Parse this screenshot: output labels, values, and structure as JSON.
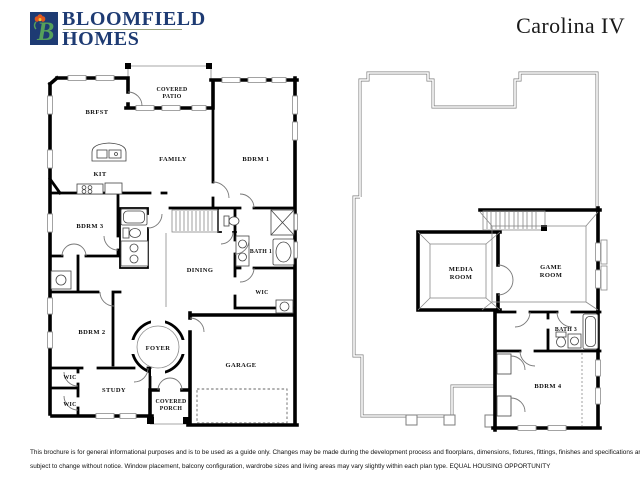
{
  "header": {
    "brand": {
      "line1": "BLOOMFIELD",
      "line2": "HOMES",
      "color": "#1e3b73"
    },
    "logo": {
      "icon": "tulip-b-monogram",
      "monogram": "B",
      "bg": "#1e3b73",
      "b_color": "#55a05a",
      "tulip_color": "#e0561e",
      "tulip_center": "#f2c12e"
    },
    "plan_name": "Carolina IV"
  },
  "floor1": {
    "labels": {
      "covered_patio_1": "COVERED",
      "covered_patio_2": "PATIO",
      "brfst": "BRFST",
      "family": "FAMILY",
      "kit": "KIT",
      "bdrm1": "BDRM 1",
      "bdrm3": "BDRM 3",
      "dining": "DINING",
      "bath1": "BATH 1",
      "wic_master": "WIC",
      "bdrm2": "BDRM 2",
      "foyer": "FOYER",
      "wic_left_upper": "WIC",
      "study": "STUDY",
      "wic_left_lower": "WIC",
      "covered_porch_1": "COVERED",
      "covered_porch_2": "PORCH",
      "garage": "GARAGE"
    }
  },
  "floor2": {
    "labels": {
      "media_room_1": "MEDIA",
      "media_room_2": "ROOM",
      "game_room_1": "GAME",
      "game_room_2": "ROOM",
      "bath3": "BATH 3",
      "bdrm4": "BDRM 4"
    }
  },
  "footer": {
    "line1": "This brochure is for general informational purposes and is to be used as a guide only. Changes may be made during the development process and floorplans, dimensions, fixtures, fittings, finishes and specifications are",
    "line2": "subject to change without notice. Window placement, balcony configuration, wardrobe sizes and living areas may vary slightly within each plan type.  EQUAL HOUSING OPPORTUNITY"
  }
}
